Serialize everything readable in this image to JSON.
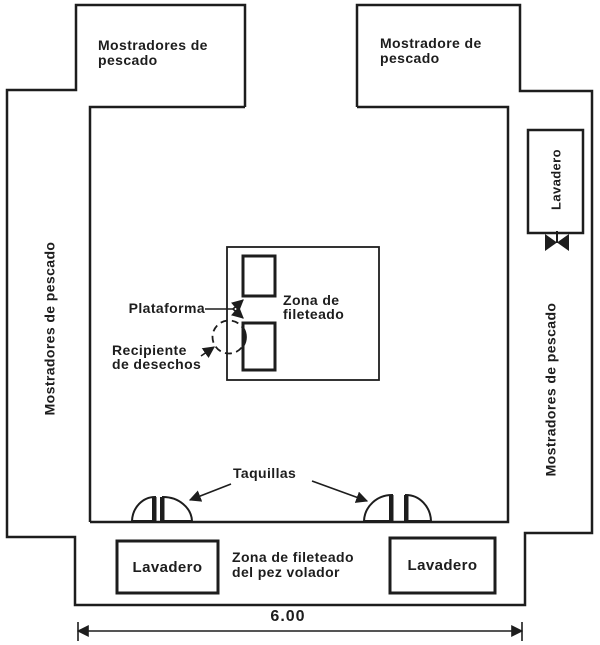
{
  "diagram": {
    "type": "floor-plan",
    "colors": {
      "ink": "#1d1d1d",
      "paper": "#ffffff"
    },
    "icons": {
      "valve": "bowtie-valve-symbol"
    },
    "labels": {
      "top_left_counter": {
        "line1": "Mostradores de",
        "line2": "pescado"
      },
      "top_right_counter": {
        "line1": "Mostradore de",
        "line2": "pescado"
      },
      "left_counter": "Mostradores de pescado",
      "right_counter": "Mostradores de pescado",
      "right_sink": "Lavadero",
      "platform": "Plataforma",
      "filleting_zone": {
        "line1": "Zona de",
        "line2": "fileteado"
      },
      "waste_container": {
        "line1": "Recipiente",
        "line2": "de desechos"
      },
      "lockers": "Taquillas",
      "bottom_left_sink": "Lavadero",
      "bottom_right_sink": "Lavadero",
      "flying_fish_zone": {
        "line1": "Zona de fileteado",
        "line2": "del pez volador"
      },
      "dimension": "6.00"
    }
  }
}
